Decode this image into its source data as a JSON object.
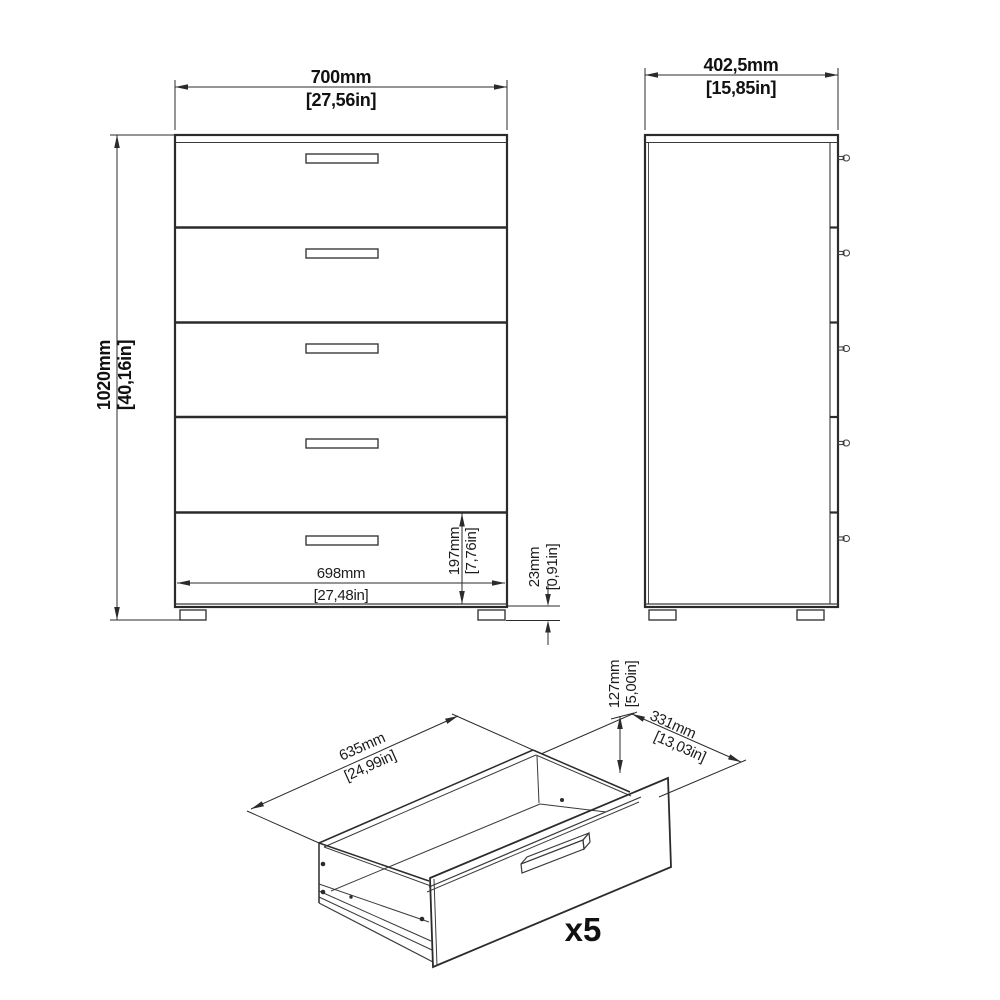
{
  "diagram_title": "5-drawer chest dimension diagram",
  "colors": {
    "background": "#ffffff",
    "line": "#2b2b2b",
    "text": "#111111"
  },
  "front_view": {
    "name": "front view",
    "drawer_count": 5,
    "width_mm": "700mm",
    "width_in": "[27,56in]",
    "height_mm": "1020mm",
    "height_in": "[40,16in]",
    "inner_width_mm": "698mm",
    "inner_width_in": "[27,48in]",
    "drawer_front_height_mm": "197mm",
    "drawer_front_height_in": "[7,76in]",
    "foot_height_mm": "23mm",
    "foot_height_in": "[0,91in]"
  },
  "side_view": {
    "name": "side view",
    "depth_mm": "402,5mm",
    "depth_in": "[15,85in]"
  },
  "drawer_view": {
    "name": "isometric drawer view",
    "inner_width_mm": "635mm",
    "inner_width_in": "[24,99in]",
    "inner_depth_mm": "331mm",
    "inner_depth_in": "[13,03in]",
    "inner_height_mm": "127mm",
    "inner_height_in": "[5,00in]",
    "quantity_label": "x5"
  }
}
